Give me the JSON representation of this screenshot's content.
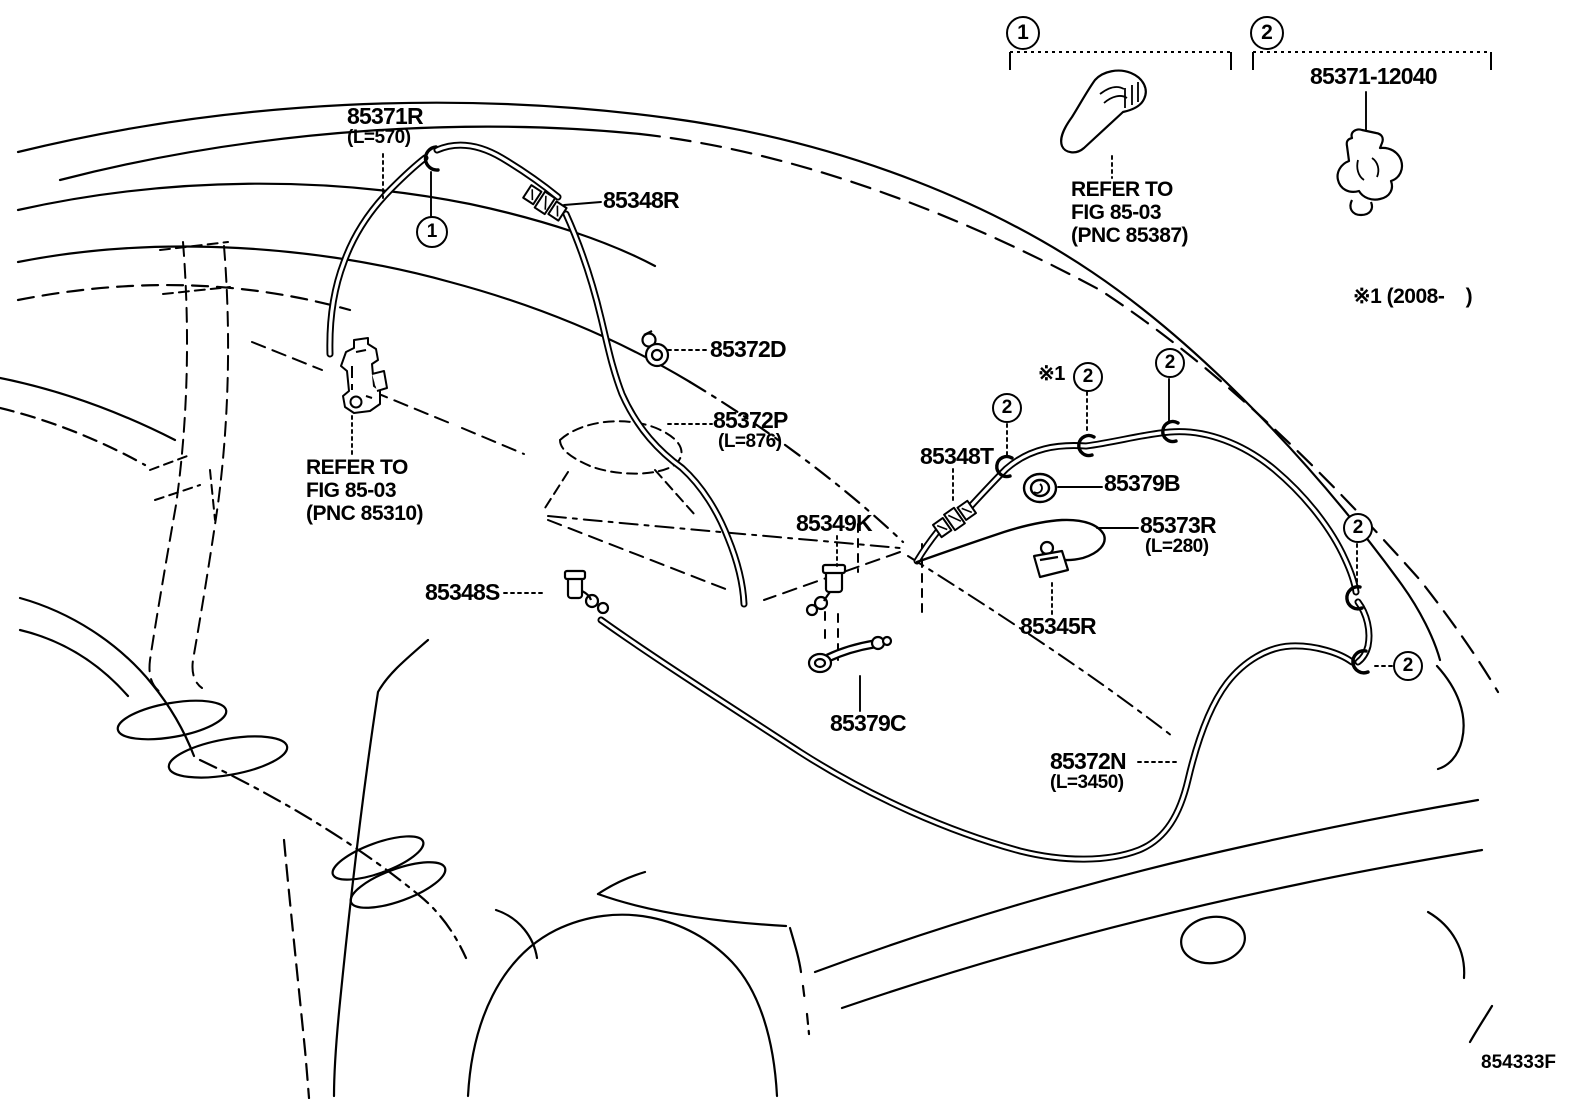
{
  "diagram": {
    "title_implied": "REAR WASHER HOSE ROUTING",
    "figure_code": "854333F",
    "colors": {
      "line": "#000000",
      "background": "#ffffff"
    },
    "parts": {
      "hose_rr_no2": {
        "number": "85371R",
        "length": "(L=570)"
      },
      "joint_r": {
        "number": "85348R"
      },
      "clip_d": {
        "number": "85372D"
      },
      "hose_p": {
        "number": "85372P",
        "length": "(L=876)"
      },
      "pump_ref": {
        "line1": "REFER TO",
        "line2": "FIG 85-03",
        "line3": "(PNC 85310)"
      },
      "joint_s": {
        "number": "85348S"
      },
      "joint_k": {
        "number": "85349K"
      },
      "joint_t": {
        "number": "85348T"
      },
      "grommet_b": {
        "number": "85379B"
      },
      "hose_r3": {
        "number": "85373R",
        "length": "(L=280)"
      },
      "clamp_r": {
        "number": "85345R"
      },
      "nozzle_c": {
        "number": "85379C"
      },
      "hose_n": {
        "number": "85372N",
        "length": "(L=3450)"
      },
      "nozzle_ref": {
        "line1": "REFER TO",
        "line2": "FIG 85-03",
        "line3": "(PNC 85387)"
      },
      "legend_clip": {
        "number": "85371-12040"
      }
    },
    "callouts": {
      "one": "1",
      "two": "2",
      "note_ref": "※1",
      "note_year": "※1 (2008-    )"
    }
  }
}
